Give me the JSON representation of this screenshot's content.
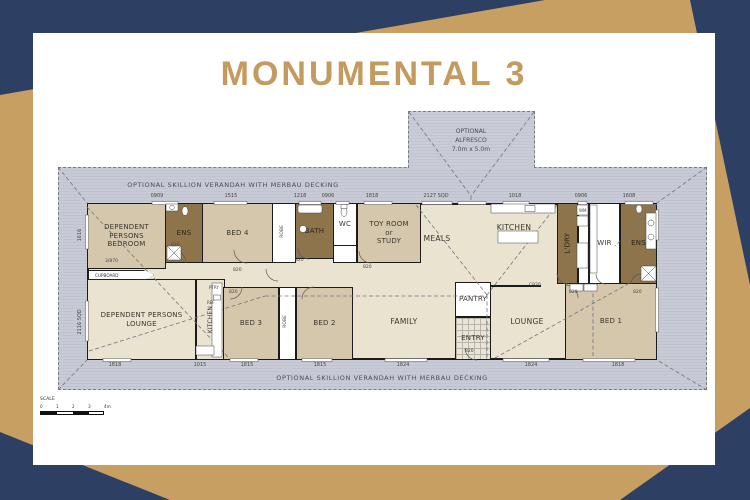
{
  "title": "MONUMENTAL 3",
  "verandah": {
    "top": "OPTIONAL SKILLION VERANDAH WITH MERBAU DECKING",
    "bottom": "OPTIONAL SKILLION VERANDAH WITH MERBAU DECKING"
  },
  "alfresco": {
    "label": "OPTIONAL\nALFRESCO\n7.0m x 5.0m"
  },
  "rooms": {
    "dp_bedroom": "DEPENDENT\nPERSONS\nBEDROOM",
    "ens_left": "ENS",
    "bed4": "BED 4",
    "bath": "BATH",
    "wc": "WC",
    "toy": "TOY ROOM\nor\nSTUDY",
    "meals": "MEALS",
    "kitchen": "KITCHEN",
    "ldry": "L'DRY",
    "wir": "WIR",
    "ens_right": "ENS",
    "dp_lounge": "DEPENDENT PERSONS\nLOUNGE",
    "kitchenette": "KITCHEN",
    "bed3": "BED 3",
    "bed2": "BED 2",
    "family": "FAMILY",
    "pantry": "PANTRY",
    "entry": "ENTRY",
    "lounge": "LOUNGE",
    "bed1": "BED 1"
  },
  "annotations": {
    "cupboard": "CUPBOARD",
    "cupboard_size": "3/870",
    "door": "820",
    "beam": "C920",
    "robe": "ROBE",
    "ptry": "PTRY",
    "fridge": "REF",
    "washer": "WM"
  },
  "dims": {
    "top": [
      "0909",
      "1515",
      "1218",
      "0906",
      "1818",
      "2127 SQD",
      "1018",
      "0906",
      "1608"
    ],
    "bottom": [
      "1818",
      "1015",
      "1815",
      "1815",
      "1824",
      "1824",
      "1818"
    ],
    "left": [
      "1616",
      "2116 SQD"
    ]
  },
  "scale": {
    "label": "SCALE",
    "ticks": [
      "0",
      "1",
      "2",
      "3",
      "4m"
    ]
  },
  "colors": {
    "navy": "#2d3f63",
    "gold": "#c79f62",
    "title_gold": "#c49a5e",
    "verandah": "#c8cbd5",
    "room_tan": "#d5c7ab",
    "room_dark": "#8d744a",
    "cream": "#eae3d0"
  }
}
